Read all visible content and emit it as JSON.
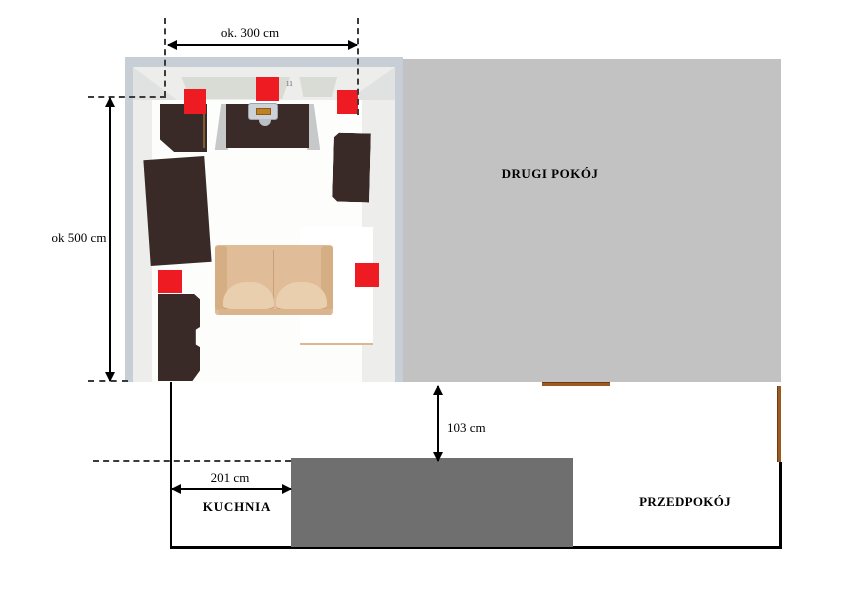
{
  "diagram": {
    "type": "apartment-floor-plan",
    "rooms": {
      "second_room": "DRUGI POKÓJ",
      "kitchen": "KUCHNIA",
      "hallway": "PRZEDPOKÓJ"
    },
    "dimensions": {
      "room_width": "ok. 300 cm",
      "room_height": "ok 500 cm",
      "counter_gap": "103 cm",
      "kitchen_width": "201 cm"
    },
    "niche_mark": "11",
    "markers": {
      "count": 5,
      "color": "#ee1b23",
      "shape": "red-square"
    },
    "colors": {
      "second_room_fill": "#c2c2c2",
      "kitchen_counter_fill": "#6f6f6f",
      "furniture_dark_wood": "#3a2a27",
      "sofa_fill": "#e0bd98",
      "living_room_wall_border": "#c7ced5",
      "door_brown": "#9d5a1e",
      "wall_line": "#000000"
    }
  }
}
